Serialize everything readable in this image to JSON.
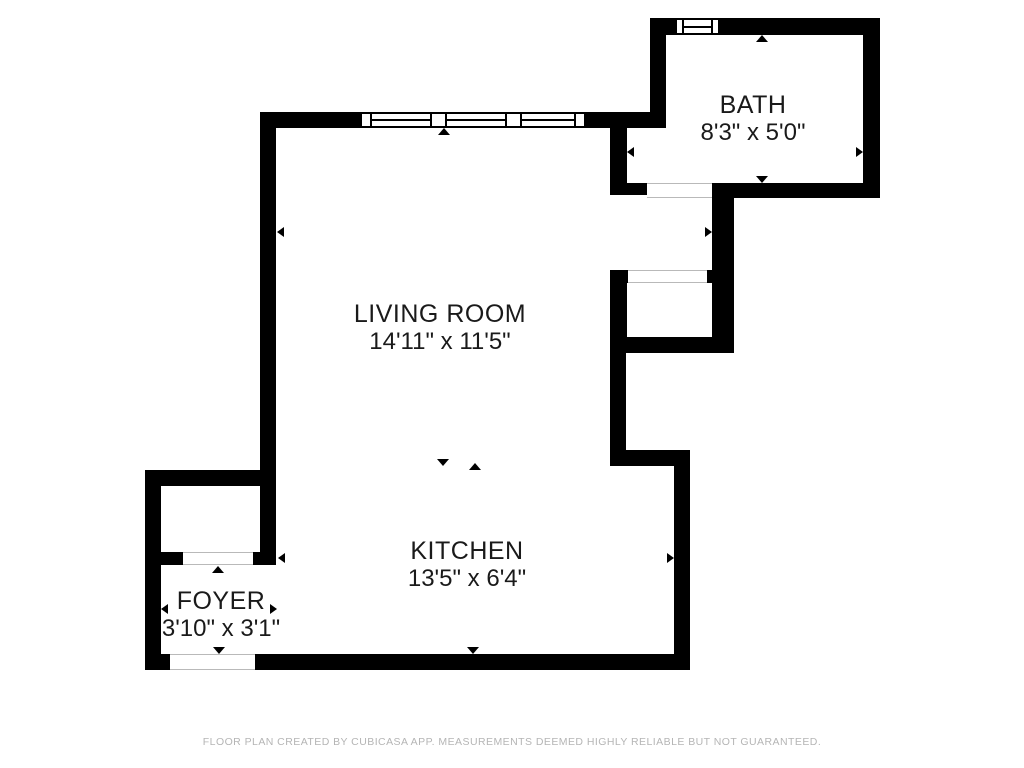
{
  "rooms": [
    {
      "id": "bath",
      "name": "BATH",
      "dimensions": "8'3\" x 5'0\""
    },
    {
      "id": "living-room",
      "name": "LIVING ROOM",
      "dimensions": "14'11\" x 11'5\""
    },
    {
      "id": "kitchen",
      "name": "KITCHEN",
      "dimensions": "13'5\" x 6'4\""
    },
    {
      "id": "foyer",
      "name": "FOYER",
      "dimensions": "3'10\" x 3'1\""
    }
  ],
  "footer": {
    "disclaimer": "FLOOR PLAN CREATED BY CUBICASA APP. MEASUREMENTS DEEMED HIGHLY RELIABLE BUT NOT GUARANTEED."
  },
  "colors": {
    "wall": "#000000",
    "background": "#ffffff",
    "opening_line": "#b9b9b9",
    "footer_text": "#b5b5b5"
  }
}
